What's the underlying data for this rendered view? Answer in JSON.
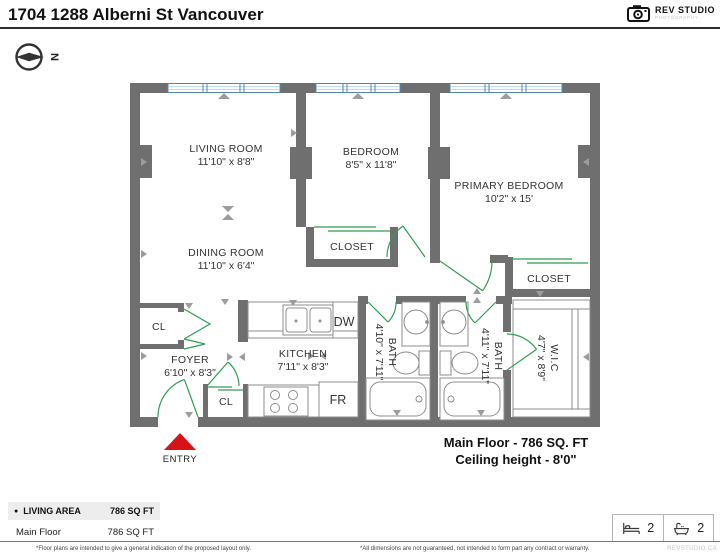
{
  "header": {
    "title": "1704 1288 Alberni St Vancouver",
    "logo_name": "REV STUDIO",
    "logo_sub": "PHOTOGRAPHY"
  },
  "compass": {
    "north": "N"
  },
  "plan": {
    "rooms": [
      {
        "name": "LIVING ROOM",
        "dims": "11'10\" x 8'8\""
      },
      {
        "name": "BEDROOM",
        "dims": "8'5\" x 11'8\""
      },
      {
        "name": "PRIMARY BEDROOM",
        "dims": "10'2\" x 15'"
      },
      {
        "name": "DINING ROOM",
        "dims": "11'10\" x 6'4\""
      },
      {
        "name": "KITCHEN",
        "dims": "7'11\" x 8'3\""
      },
      {
        "name": "FOYER",
        "dims": "6'10\" x 8'3\""
      },
      {
        "name": "BATH",
        "dims": "4'10\" x 7'11\""
      },
      {
        "name": "BATH",
        "dims": "4'11\" x 7'11\""
      },
      {
        "name": "W.I.C",
        "dims": "4'7\" x 8'9\""
      }
    ],
    "closets": {
      "bedroom": "CLOSET",
      "primary": "CLOSET",
      "foyer": "CL",
      "kitchen": "CL"
    },
    "appliances": {
      "dishwasher": "DW",
      "fridge": "FR"
    },
    "entry": "ENTRY",
    "floor_title": "Main Floor - 786 SQ. FT",
    "ceiling": "Ceiling height - 8'0\""
  },
  "summary": {
    "bullet": "●",
    "header_label": "LIVING AREA",
    "header_value": "786 SQ FT",
    "rows": [
      {
        "label": "Main Floor",
        "value": "786 SQ FT"
      }
    ]
  },
  "stats": {
    "beds": "2",
    "baths": "2"
  },
  "footer": {
    "note_left": "*Floor plans are intended to give a general indication of the proposed layout only.",
    "note_right": "*All dimensions are not guaranteed, not intended to form part any contract or warranty.",
    "brand": "REVSTUDIO.CA"
  },
  "colors": {
    "wall": "#6f6f6f",
    "door": "#2f9e52",
    "window_frame": "#4d87ba",
    "entry_marker": "#d61418"
  }
}
